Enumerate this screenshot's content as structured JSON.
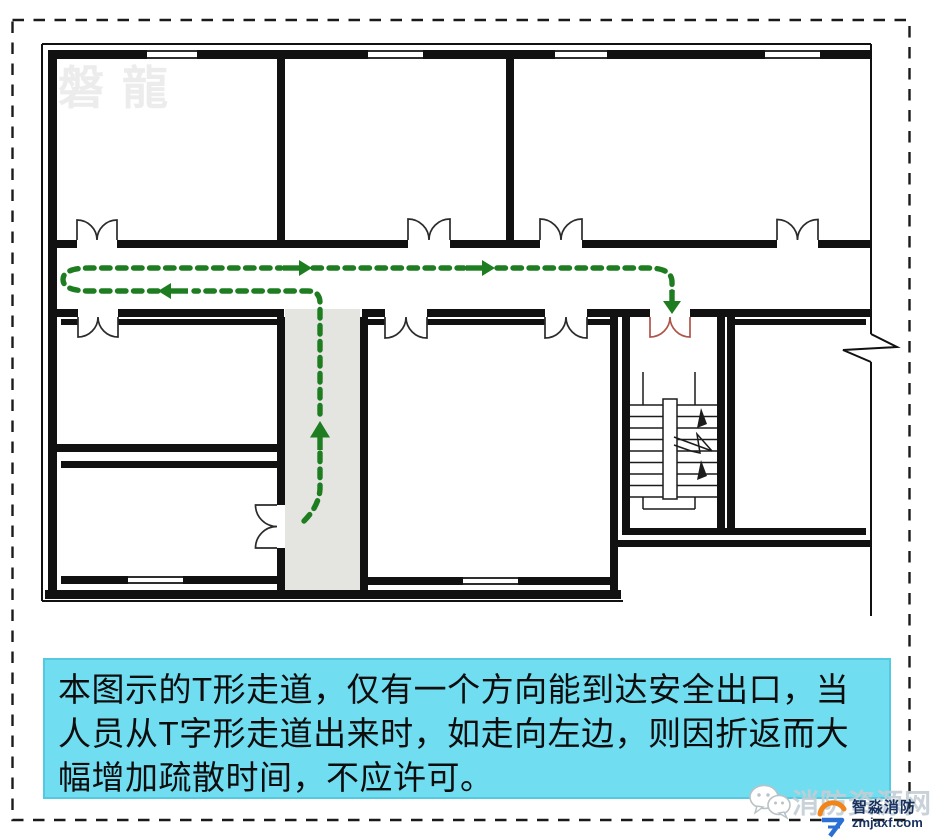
{
  "colors": {
    "wall": "#111111",
    "route-green": "#1d7d20",
    "door-red": "#b0544a",
    "corridor-gray": "#e4e4e1",
    "caption-bg": "#71ddf1",
    "caption-border": "#54c9e0",
    "caption-text": "#0d0d0d",
    "watermark-gray": "#ececec",
    "site-watermark": "#c3ced4",
    "brand-navy": "#17325f",
    "brand-orange": "#f08519",
    "brand-blue": "#2b6fd4"
  },
  "plan_watermark": "磐龍",
  "caption": {
    "line1": "本图示的T形走道，仅有一个方向能到达安全出口，当",
    "line2": "人员从T字形走道出来时，如走向左边，则因折返而大",
    "line3": "幅增加疏散时间，不应许可。"
  },
  "branding": {
    "site_watermark": "消防资源网",
    "brand_name": "智淼消防",
    "brand_domain": "zmjaxf.com"
  }
}
